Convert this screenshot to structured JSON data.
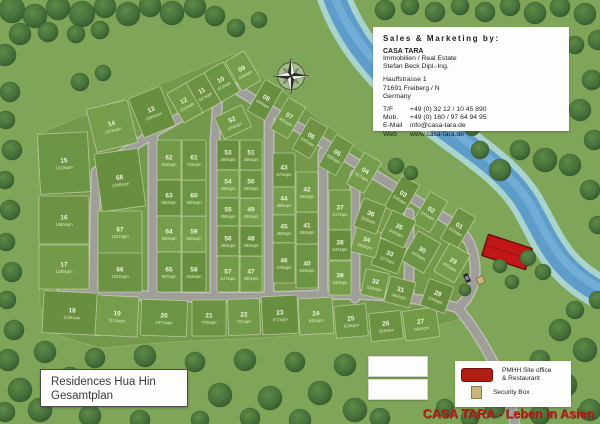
{
  "title_box": {
    "line1": "Residences Hua Hin",
    "line2": "Gesamtplan"
  },
  "sales_box": {
    "heading": "Sales & Marketing by:",
    "company": "CASA TARA",
    "line1": "Immobilien / Real Estate",
    "line2": "Stefan Beck Dipl.-Ing.",
    "addr1": "Hauffstrasse 1",
    "addr2": "71691 Freiberg / N",
    "addr3": "Germany",
    "contacts": [
      {
        "label": "T/F",
        "value": "+49 (0) 32 12 / 10 45 890"
      },
      {
        "label": "Mob.",
        "value": "+49 (0) 160 / 97 64 94 95"
      },
      {
        "label": "E-Mail",
        "value": "info@casa-tara.de"
      },
      {
        "label": "Web",
        "value": "www.casa-tara.de"
      }
    ]
  },
  "legend": {
    "site_office_line1": "PMHH Site office",
    "site_office_line2": "& Restaurant",
    "security_label": "Security Box"
  },
  "slogan": "CASA TARA - Leben in Asien",
  "compass": "compass-rose-north-up",
  "colors": {
    "slogan_red": "#b5241c",
    "office_red": "#c21717",
    "river_blue": "#5e9dc9",
    "road_gray": "#9f9e98",
    "estate_green": "#75994c",
    "grass_green": "#7fa558"
  },
  "lots": [
    {
      "n": "01",
      "a": "532sqm",
      "x": 458,
      "y": 228,
      "w": 20,
      "h": 36,
      "r": 30
    },
    {
      "n": "02",
      "a": "545sqm",
      "x": 430,
      "y": 212,
      "w": 20,
      "h": 36,
      "r": 30
    },
    {
      "n": "03",
      "a": "546sqm",
      "x": 402,
      "y": 196,
      "w": 20,
      "h": 36,
      "r": 30
    },
    {
      "n": "04",
      "a": "567sqm",
      "x": 364,
      "y": 173,
      "w": 20,
      "h": 36,
      "r": 30
    },
    {
      "n": "05",
      "a": "599sqm",
      "x": 336,
      "y": 155,
      "w": 20,
      "h": 36,
      "r": 30
    },
    {
      "n": "06",
      "a": "545sqm",
      "x": 310,
      "y": 138,
      "w": 20,
      "h": 36,
      "r": 30
    },
    {
      "n": "07",
      "a": "465sqm",
      "x": 288,
      "y": 118,
      "w": 20,
      "h": 36,
      "r": 30
    },
    {
      "n": "08",
      "a": "444sqm",
      "x": 265,
      "y": 100,
      "w": 20,
      "h": 36,
      "r": 30
    },
    {
      "n": "09",
      "a": "536sqm",
      "x": 243,
      "y": 71,
      "w": 22,
      "h": 34,
      "r": -30
    },
    {
      "n": "10",
      "a": "473sqm",
      "x": 222,
      "y": 82,
      "w": 22,
      "h": 34,
      "r": -30
    },
    {
      "n": "11",
      "a": "447sqm",
      "x": 203,
      "y": 93,
      "w": 22,
      "h": 34,
      "r": -30
    },
    {
      "n": "12",
      "a": "532sqm",
      "x": 185,
      "y": 103,
      "w": 22,
      "h": 34,
      "r": -30
    },
    {
      "n": "13",
      "a": "1083sqm",
      "x": 152,
      "y": 112,
      "w": 34,
      "h": 42,
      "r": -22
    },
    {
      "n": "14",
      "a": "1078sqm",
      "x": 112,
      "y": 126,
      "w": 42,
      "h": 44,
      "r": -14
    },
    {
      "n": "15",
      "a": "1210sqm",
      "x": 64,
      "y": 163,
      "w": 50,
      "h": 60,
      "r": -3
    },
    {
      "n": "16",
      "a": "1860sqm",
      "x": 64,
      "y": 220,
      "w": 50,
      "h": 48,
      "r": 0
    },
    {
      "n": "17",
      "a": "1185sqm",
      "x": 64,
      "y": 267,
      "w": 50,
      "h": 44,
      "r": 0
    },
    {
      "n": "18",
      "a": "1156sqm",
      "x": 72,
      "y": 313,
      "w": 58,
      "h": 42,
      "r": 3
    },
    {
      "n": "19",
      "a": "1113sqm",
      "x": 117,
      "y": 316,
      "w": 42,
      "h": 40,
      "r": 3
    },
    {
      "n": "20",
      "a": "1971sqm",
      "x": 164,
      "y": 318,
      "w": 46,
      "h": 36,
      "r": 2
    },
    {
      "n": "21",
      "a": "779sqm",
      "x": 209,
      "y": 318,
      "w": 34,
      "h": 36,
      "r": 0
    },
    {
      "n": "22",
      "a": "721sqm",
      "x": 244,
      "y": 317,
      "w": 32,
      "h": 36,
      "r": -2
    },
    {
      "n": "23",
      "a": "677sqm",
      "x": 280,
      "y": 315,
      "w": 36,
      "h": 38,
      "r": -3
    },
    {
      "n": "24",
      "a": "642sqm",
      "x": 316,
      "y": 316,
      "w": 34,
      "h": 36,
      "r": -3
    },
    {
      "n": "25",
      "a": "616sqm",
      "x": 351,
      "y": 321,
      "w": 32,
      "h": 32,
      "r": -5
    },
    {
      "n": "26",
      "a": "565sqm",
      "x": 386,
      "y": 326,
      "w": 32,
      "h": 28,
      "r": -6
    },
    {
      "n": "27",
      "a": "564sqm",
      "x": 421,
      "y": 324,
      "w": 34,
      "h": 30,
      "r": -8
    },
    {
      "n": "28",
      "a": "533sqm",
      "x": 437,
      "y": 296,
      "w": 26,
      "h": 28,
      "r": 20
    },
    {
      "n": "29",
      "a": "489sqm",
      "x": 452,
      "y": 263,
      "w": 24,
      "h": 32,
      "r": 30
    },
    {
      "n": "30",
      "a": "643sqm",
      "x": 421,
      "y": 252,
      "w": 26,
      "h": 34,
      "r": 30
    },
    {
      "n": "31",
      "a": "482sqm",
      "x": 400,
      "y": 292,
      "w": 26,
      "h": 26,
      "r": 15
    },
    {
      "n": "32",
      "a": "510sqm",
      "x": 375,
      "y": 284,
      "w": 24,
      "h": 26,
      "r": 12
    },
    {
      "n": "33",
      "a": "677sqm",
      "x": 389,
      "y": 256,
      "w": 28,
      "h": 28,
      "r": 20
    },
    {
      "n": "34",
      "a": "683sqm",
      "x": 366,
      "y": 242,
      "w": 26,
      "h": 26,
      "r": 15
    },
    {
      "n": "35",
      "a": "543sqm",
      "x": 398,
      "y": 229,
      "w": 26,
      "h": 30,
      "r": 25
    },
    {
      "n": "36",
      "a": "550sqm",
      "x": 370,
      "y": 216,
      "w": 24,
      "h": 30,
      "r": 20
    },
    {
      "n": "37",
      "a": "617sqm",
      "x": 340,
      "y": 210,
      "w": 22,
      "h": 40,
      "r": 0
    },
    {
      "n": "38",
      "a": "541sqm",
      "x": 340,
      "y": 245,
      "w": 22,
      "h": 30,
      "r": 0
    },
    {
      "n": "39",
      "a": "533sqm",
      "x": 340,
      "y": 278,
      "w": 22,
      "h": 34,
      "r": 0
    },
    {
      "n": "40",
      "a": "546sqm",
      "x": 307,
      "y": 266,
      "w": 22,
      "h": 44,
      "r": 0
    },
    {
      "n": "41",
      "a": "556sqm",
      "x": 307,
      "y": 228,
      "w": 22,
      "h": 32,
      "r": 0
    },
    {
      "n": "42",
      "a": "685sqm",
      "x": 307,
      "y": 192,
      "w": 22,
      "h": 40,
      "r": 0
    },
    {
      "n": "43",
      "a": "574sqm",
      "x": 284,
      "y": 170,
      "w": 22,
      "h": 34,
      "r": 0
    },
    {
      "n": "44",
      "a": "456sqm",
      "x": 284,
      "y": 201,
      "w": 22,
      "h": 28,
      "r": 0
    },
    {
      "n": "45",
      "a": "456sqm",
      "x": 284,
      "y": 229,
      "w": 22,
      "h": 28,
      "r": 0
    },
    {
      "n": "46",
      "a": "476sqm",
      "x": 284,
      "y": 263,
      "w": 22,
      "h": 40,
      "r": 0
    },
    {
      "n": "47",
      "a": "465sqm",
      "x": 251,
      "y": 274,
      "w": 22,
      "h": 36,
      "r": 0
    },
    {
      "n": "48",
      "a": "455sqm",
      "x": 251,
      "y": 241,
      "w": 22,
      "h": 30,
      "r": 0
    },
    {
      "n": "49",
      "a": "455sqm",
      "x": 251,
      "y": 212,
      "w": 22,
      "h": 28,
      "r": 0
    },
    {
      "n": "50",
      "a": "455sqm",
      "x": 251,
      "y": 184,
      "w": 22,
      "h": 28,
      "r": 0
    },
    {
      "n": "51",
      "a": "455sqm",
      "x": 251,
      "y": 155,
      "w": 22,
      "h": 30,
      "r": 0
    },
    {
      "n": "52",
      "a": "634sqm",
      "x": 233,
      "y": 122,
      "w": 30,
      "h": 24,
      "r": -25
    },
    {
      "n": "53",
      "a": "456sqm",
      "x": 228,
      "y": 155,
      "w": 22,
      "h": 30,
      "r": 0
    },
    {
      "n": "54",
      "a": "456sqm",
      "x": 228,
      "y": 184,
      "w": 22,
      "h": 28,
      "r": 0
    },
    {
      "n": "55",
      "a": "456sqm",
      "x": 228,
      "y": 212,
      "w": 22,
      "h": 28,
      "r": 0
    },
    {
      "n": "56",
      "a": "489sqm",
      "x": 228,
      "y": 241,
      "w": 22,
      "h": 30,
      "r": 0
    },
    {
      "n": "57",
      "a": "547sqm",
      "x": 228,
      "y": 274,
      "w": 22,
      "h": 36,
      "r": 0
    },
    {
      "n": "58",
      "a": "618sqm",
      "x": 194,
      "y": 272,
      "w": 24,
      "h": 40,
      "r": 0
    },
    {
      "n": "59",
      "a": "550sqm",
      "x": 194,
      "y": 234,
      "w": 24,
      "h": 36,
      "r": 0
    },
    {
      "n": "60",
      "a": "550sqm",
      "x": 194,
      "y": 198,
      "w": 24,
      "h": 36,
      "r": 0
    },
    {
      "n": "61",
      "a": "729sqm",
      "x": 194,
      "y": 160,
      "w": 24,
      "h": 40,
      "r": 0
    },
    {
      "n": "62",
      "a": "818sqm",
      "x": 169,
      "y": 160,
      "w": 24,
      "h": 40,
      "r": 0
    },
    {
      "n": "63",
      "a": "550sqm",
      "x": 169,
      "y": 198,
      "w": 24,
      "h": 36,
      "r": 0
    },
    {
      "n": "64",
      "a": "550sqm",
      "x": 169,
      "y": 234,
      "w": 24,
      "h": 36,
      "r": 0
    },
    {
      "n": "65",
      "a": "567sqm",
      "x": 169,
      "y": 272,
      "w": 24,
      "h": 40,
      "r": 0
    },
    {
      "n": "66",
      "a": "1034sqm",
      "x": 120,
      "y": 272,
      "w": 44,
      "h": 40,
      "r": 0
    },
    {
      "n": "67",
      "a": "1037sqm",
      "x": 120,
      "y": 232,
      "w": 44,
      "h": 42,
      "r": 0
    },
    {
      "n": "68",
      "a": "1240sqm",
      "x": 120,
      "y": 180,
      "w": 44,
      "h": 58,
      "r": -8
    }
  ]
}
